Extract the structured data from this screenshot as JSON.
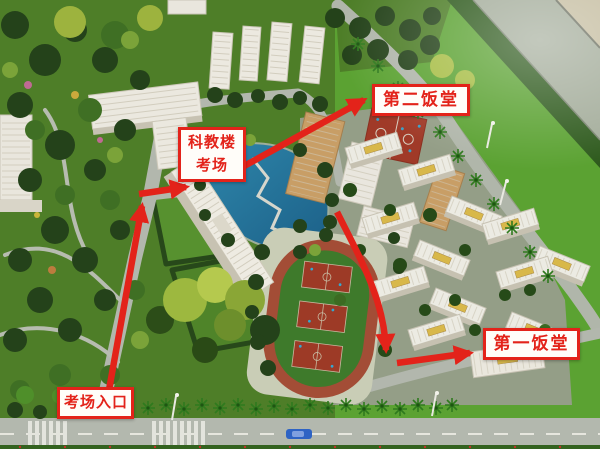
{
  "photo": {
    "labels": {
      "canteen2": "第二饭堂",
      "exam_building_line1": "科教楼",
      "exam_building_line2": "考场",
      "canteen1": "第一饭堂",
      "entrance": "考场入口"
    },
    "colors": {
      "annotation_red": "#e3231a",
      "label_background": "#fffdf9",
      "lawn_green": "#4e7e28",
      "bright_lawn_green": "#5ba232",
      "pond_teal": "#236f93",
      "track_ring_red": "#a34d36",
      "court_red": "#9d3a26",
      "road_gray": "#b2b7ad",
      "building_white": "#ece9e0",
      "building_tan": "#c89e66"
    }
  }
}
